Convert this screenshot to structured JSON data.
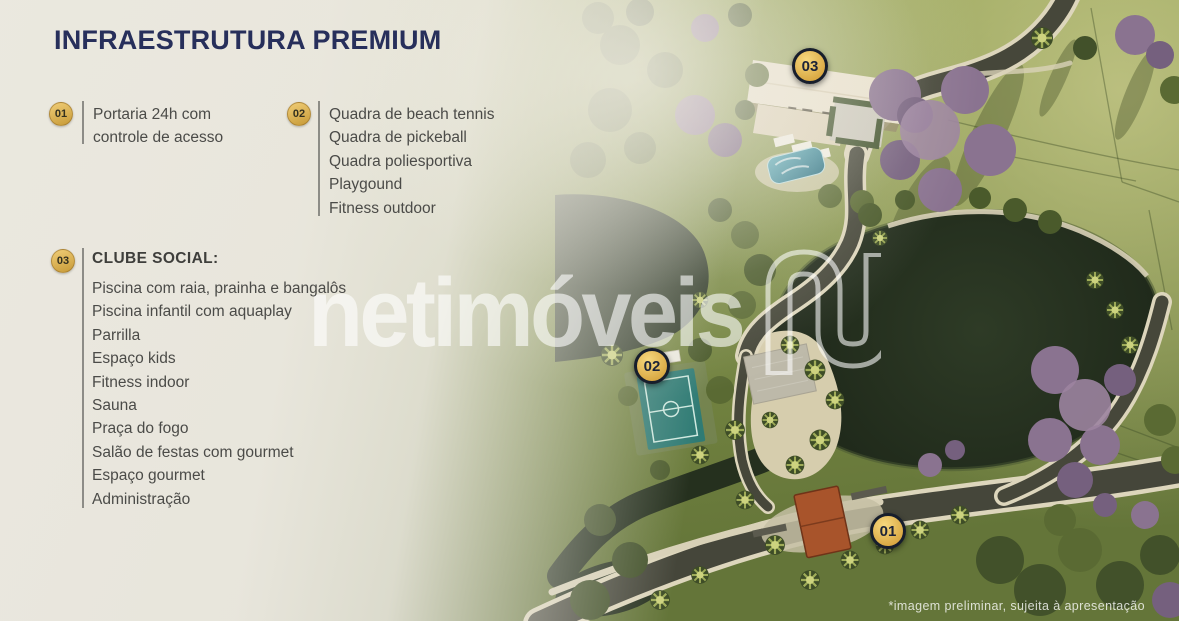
{
  "title": "INFRAESTRUTURA PREMIUM",
  "legend": {
    "groups": [
      {
        "number": "01",
        "lines": [
          "Portaria 24h com",
          "controle de acesso"
        ]
      },
      {
        "number": "02",
        "items": [
          "Quadra de beach tennis",
          "Quadra de pickeball",
          "Quadra poliesportiva",
          "Playgound",
          "Fitness outdoor"
        ]
      },
      {
        "number": "03",
        "heading": "CLUBE SOCIAL:",
        "items": [
          "Piscina com raia, prainha e bangalôs",
          "Piscina infantil com aquaplay",
          "Parrilla",
          "Espaço kids",
          "Fitness indoor",
          "Sauna",
          "Praça do fogo",
          "Salão de festas com gourmet",
          "Espaço gourmet",
          "Administração"
        ]
      }
    ]
  },
  "map_markers": [
    {
      "label": "03"
    },
    {
      "label": "02"
    },
    {
      "label": "01"
    }
  ],
  "watermark": {
    "brand": "netimóveis",
    "logo_icon": "netimoveis-n-logo"
  },
  "disclaimer": "*imagem preliminar, sujeita à apresentação",
  "colors": {
    "navy": "#272f5b",
    "text": "#4b4b48",
    "gold": "#d9a843",
    "gold_light": "#f0cd77",
    "gold_dark": "#c79a37",
    "marker_ring": "#171e2c",
    "panel": "#ebe8e0",
    "lake": "#1f2919",
    "lawn": "#7e8d46",
    "road": "#45463a",
    "curb": "#ddd6bc",
    "sand": "#d6cdad",
    "court": "#2f7b74",
    "purple_tree": "#8a7390",
    "gatehouse": "#a8542b",
    "pool": "#2f7f93"
  }
}
